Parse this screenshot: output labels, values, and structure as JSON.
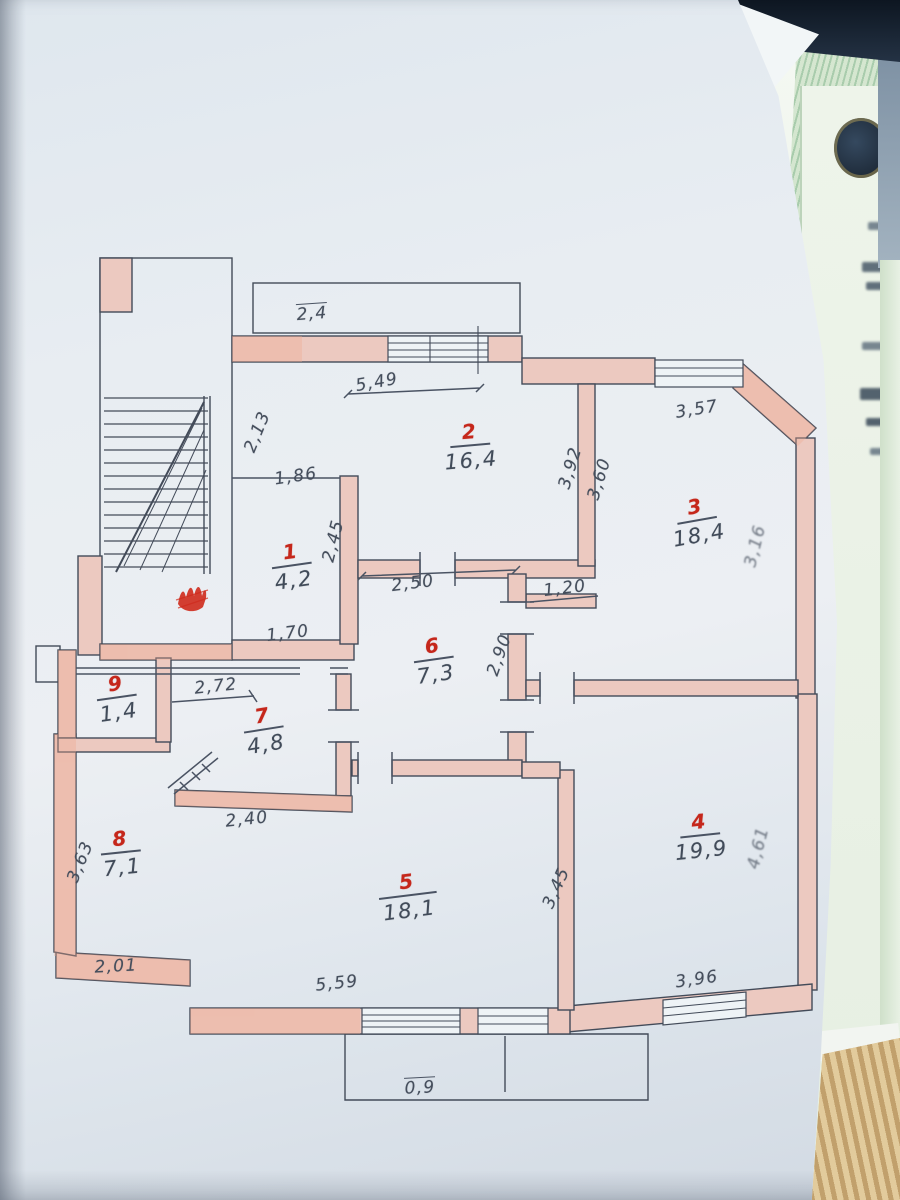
{
  "photo": {
    "description": "Hand-drawn apartment floor plan (technical passport sheet) photographed on top of a green security-pattern certificate document",
    "colors": {
      "paper": "#e8edf2",
      "wall_fill": "#ecc9c0",
      "wall_tint": "#f0a88f",
      "pencil": "#4a5363",
      "red_ink": "#c5271b",
      "certificate_green": "#cfe3cd",
      "dark_corner": "#18222e",
      "paper_stack_tan": "#d6b988"
    }
  },
  "plan": {
    "rooms": [
      {
        "number": "1",
        "area": "4,2"
      },
      {
        "number": "2",
        "area": "16,4"
      },
      {
        "number": "3",
        "area": "18,4"
      },
      {
        "number": "4",
        "area": "19,9"
      },
      {
        "number": "5",
        "area": "18,1"
      },
      {
        "number": "6",
        "area": "7,3"
      },
      {
        "number": "7",
        "area": "4,8"
      },
      {
        "number": "8",
        "area": "7,1"
      },
      {
        "number": "9",
        "area": "1,4"
      }
    ],
    "dims": [
      {
        "text": "2,4"
      },
      {
        "text": "5,49"
      },
      {
        "text": "2,13"
      },
      {
        "text": "1,86"
      },
      {
        "text": "2,45"
      },
      {
        "text": "2,50"
      },
      {
        "text": "1,70"
      },
      {
        "text": "3,92"
      },
      {
        "text": "3,60"
      },
      {
        "text": "3,57"
      },
      {
        "text": "1,20"
      },
      {
        "text": "3,16"
      },
      {
        "text": "2,90"
      },
      {
        "text": "2,72"
      },
      {
        "text": "2,40"
      },
      {
        "text": "3,63"
      },
      {
        "text": "2,01"
      },
      {
        "text": "5,59"
      },
      {
        "text": "3,45"
      },
      {
        "text": "3,96"
      },
      {
        "text": "4,61"
      },
      {
        "text": "0,9"
      }
    ]
  }
}
